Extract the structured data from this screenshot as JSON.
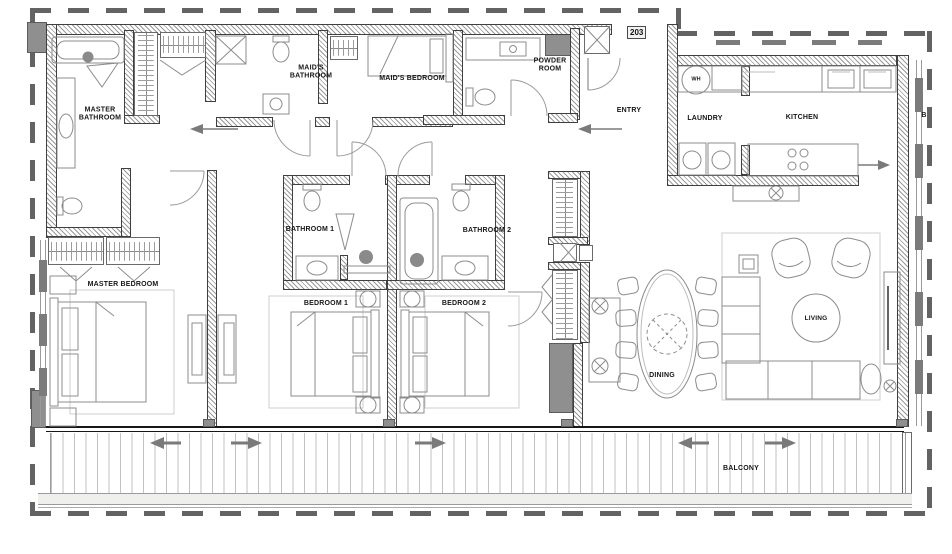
{
  "unit": {
    "number": "203",
    "grid_label": "B"
  },
  "rooms": {
    "master_bathroom": {
      "label": "MASTER BATHROOM"
    },
    "maids_bathroom": {
      "label": "MAID'S BATHROOM"
    },
    "maids_bedroom": {
      "label": "MAID'S BEDROOM"
    },
    "powder_room": {
      "label": "POWDER ROOM"
    },
    "entry": {
      "label": "ENTRY"
    },
    "laundry": {
      "label": "LAUNDRY"
    },
    "kitchen": {
      "label": "KITCHEN"
    },
    "bathroom_1": {
      "label": "BATHROOM 1"
    },
    "bathroom_2": {
      "label": "BATHROOM 2"
    },
    "master_bedroom": {
      "label": "MASTER BEDROOM"
    },
    "bedroom_1": {
      "label": "BEDROOM 1"
    },
    "bedroom_2": {
      "label": "BEDROOM 2"
    },
    "dining": {
      "label": "DINING"
    },
    "living": {
      "label": "LIVING"
    },
    "balcony": {
      "label": "BALCONY"
    }
  },
  "equipment": {
    "water_heater": "WH"
  },
  "colors": {
    "wall_line": "#3f3f3f",
    "wall_hatch": "#9a9a9a",
    "furniture_line": "#8c8c8c",
    "shaft_fill": "#8f8f8f",
    "property_dash": "#636363",
    "deck_line": "#c2c2c2",
    "label_text": "#161616",
    "arrow_gray": "#7a7a7a"
  }
}
